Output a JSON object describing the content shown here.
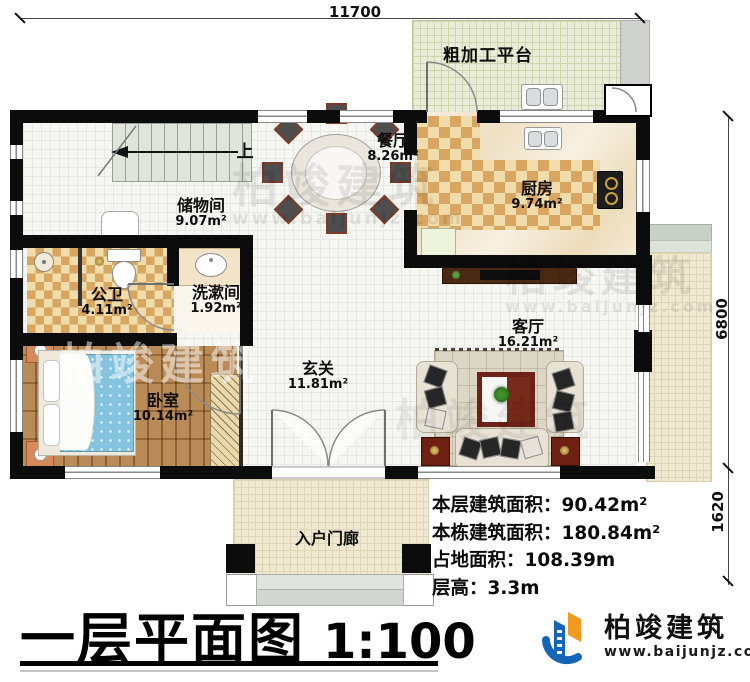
{
  "plan": {
    "title": "一层平面图",
    "scale": "1:100",
    "stair_direction": "上"
  },
  "dimensions": {
    "top_width": "11700",
    "right_upper": "6800",
    "right_lower": "1620"
  },
  "rooms": [
    {
      "name": "粗加工平台",
      "area": ""
    },
    {
      "name": "餐厅",
      "area": "8.26m²"
    },
    {
      "name": "厨房",
      "area": "9.74m²"
    },
    {
      "name": "储物间",
      "area": "9.07m²"
    },
    {
      "name": "公卫",
      "area": "4.11m²"
    },
    {
      "name": "洗漱间",
      "area": "1.92m²"
    },
    {
      "name": "玄关",
      "area": "11.81m²"
    },
    {
      "name": "卧室",
      "area": "10.14m²"
    },
    {
      "name": "客厅",
      "area": "16.21m²"
    },
    {
      "name": "入户门廊",
      "area": ""
    }
  ],
  "stats": [
    {
      "label": "本层建筑面积：",
      "value": "90.42m²"
    },
    {
      "label": "本栋建筑面积：",
      "value": "180.84m²"
    },
    {
      "label": "占地面积：",
      "value": "108.39m"
    },
    {
      "label": "层高：",
      "value": "3.3m"
    }
  ],
  "logo": {
    "company": "柏竣建筑",
    "website": "www.baijunjz.com"
  },
  "watermark": {
    "text": "柏竣建筑",
    "sub": "www.baijunjz.com"
  },
  "colors": {
    "wall": "#0c0c0c",
    "wood_floor": "#b5824a",
    "checker_light": "#f1dcab",
    "checker_dark": "#d8a660",
    "platform_green": "#e9ecd7",
    "porch_beige": "#f0e9d1",
    "bed_blue": "#85c4de",
    "logo_blue": "#1666b8",
    "logo_orange": "#f29a1f"
  }
}
